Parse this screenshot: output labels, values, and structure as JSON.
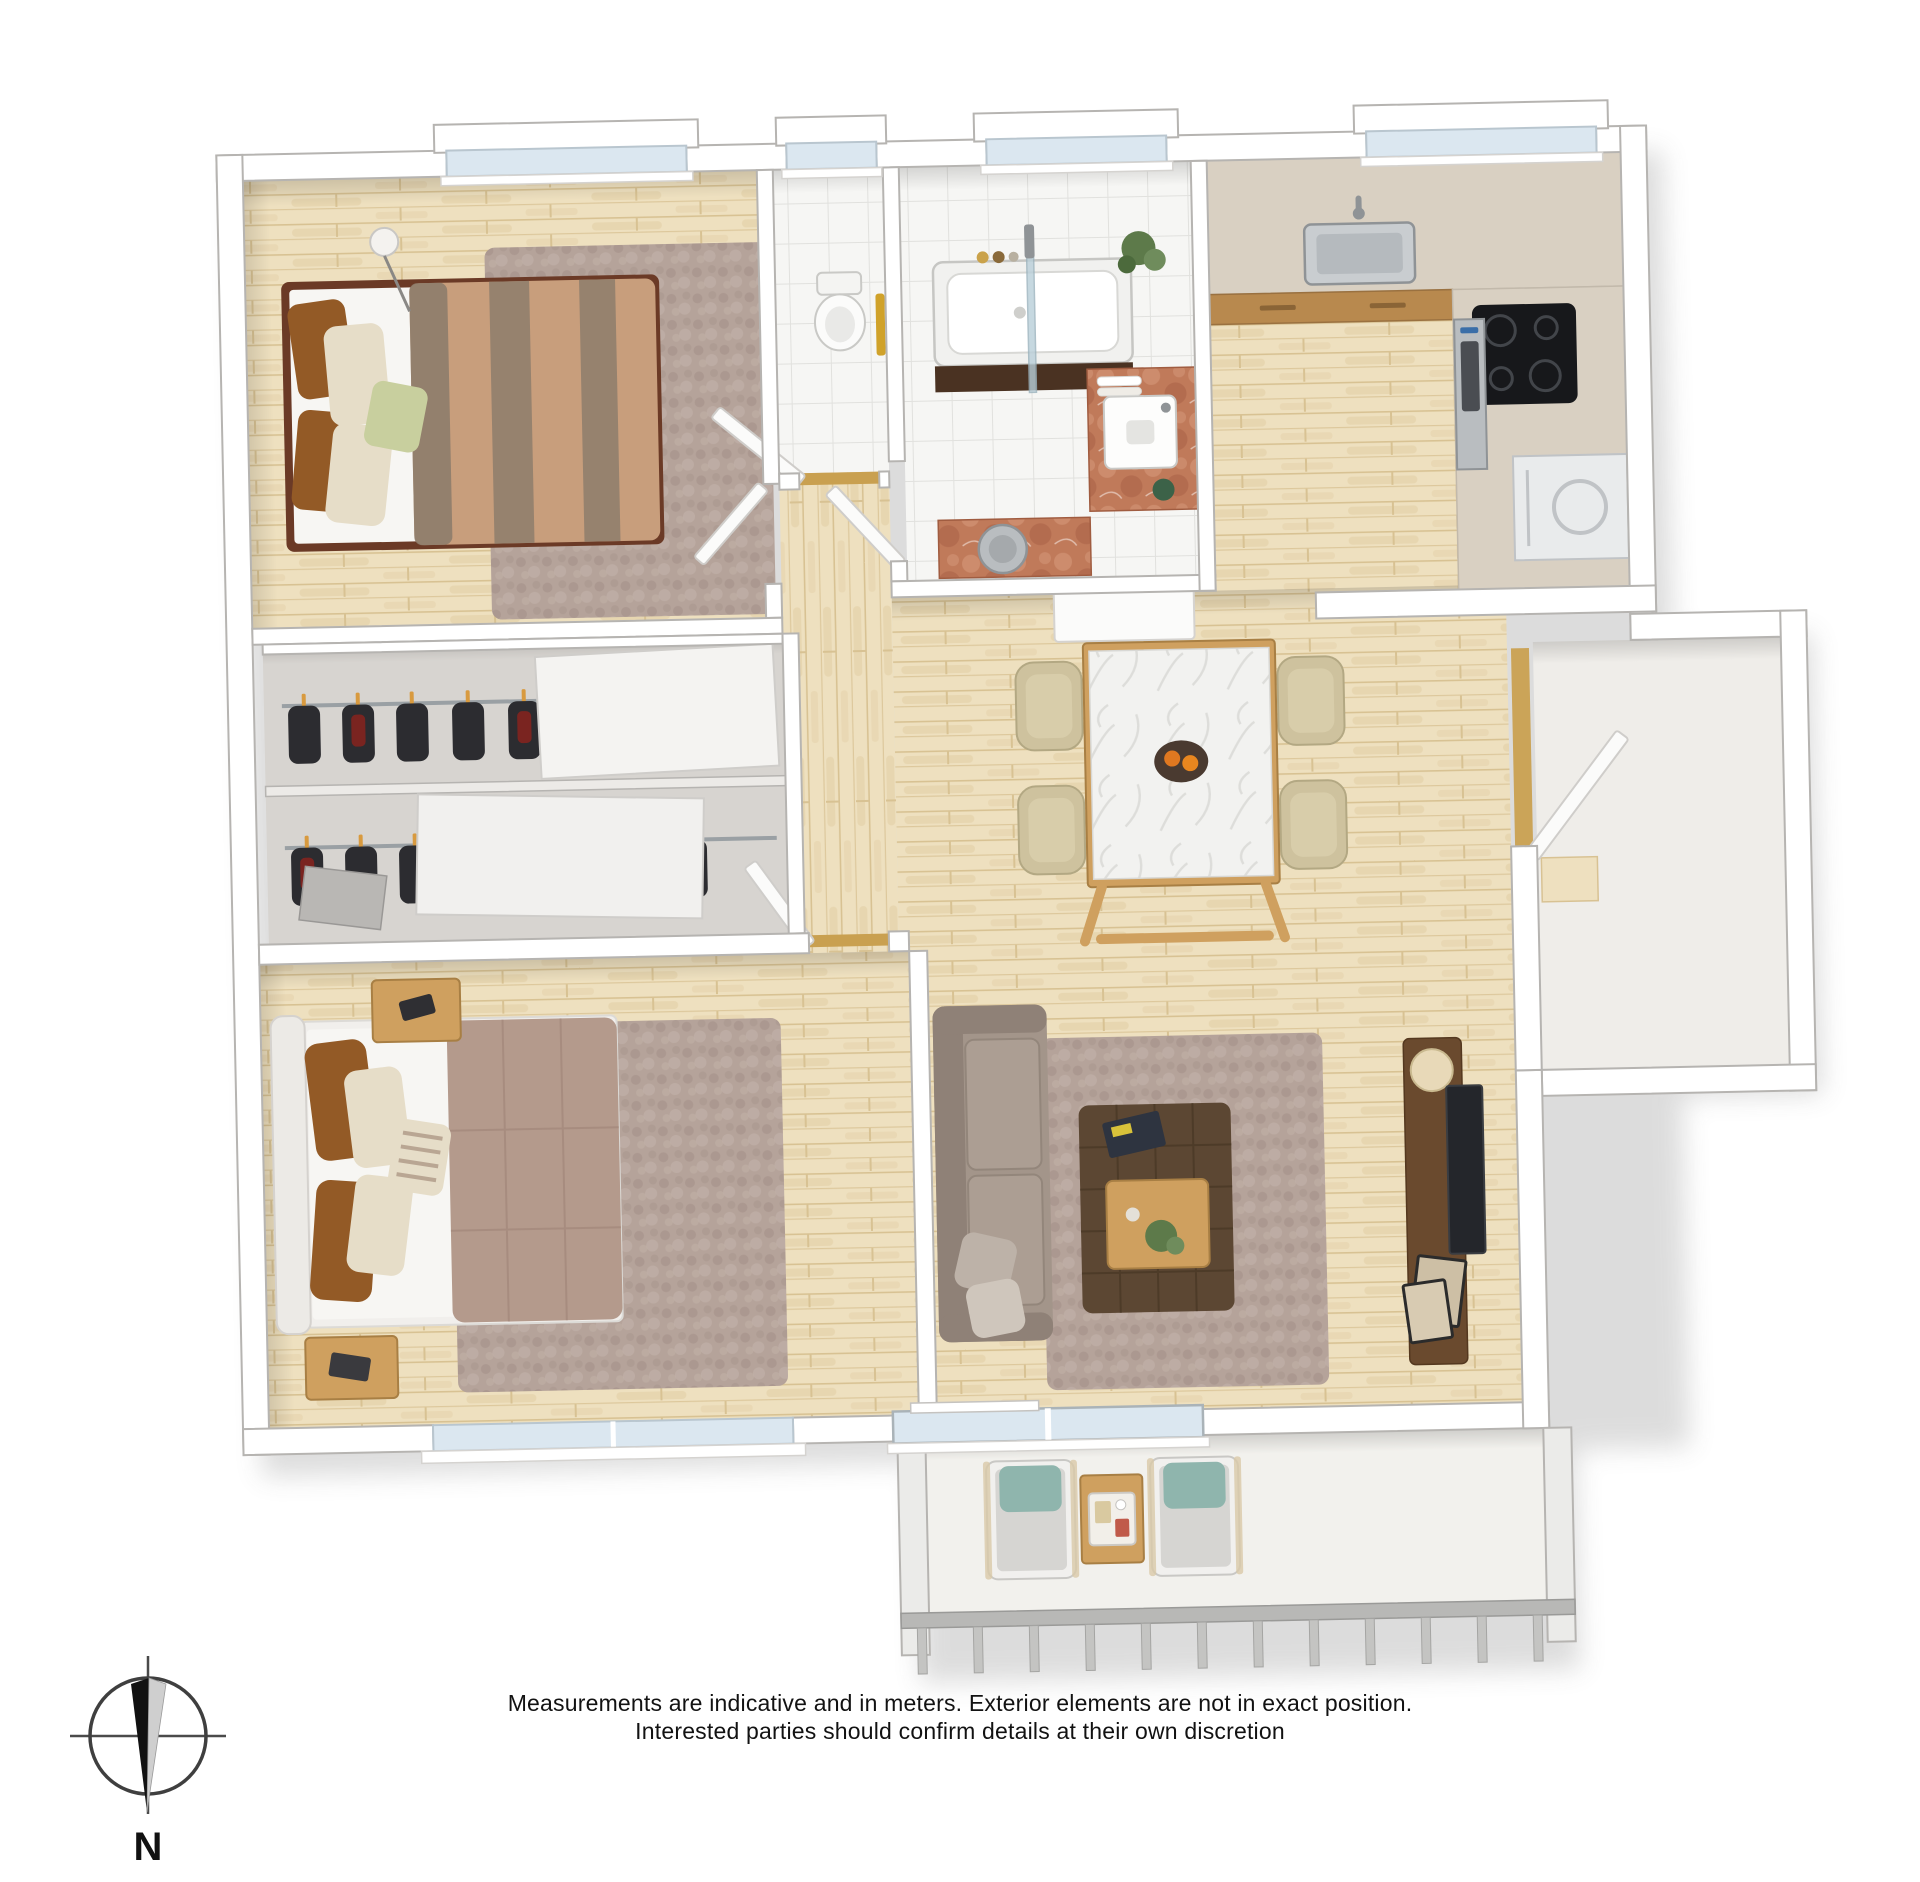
{
  "compass": {
    "label": "N",
    "needle_direction": "down",
    "ring_color": "#3f3f3f",
    "needle_dark": "#111111",
    "needle_light": "#cfcfcf"
  },
  "disclaimer": {
    "line1": "Measurements are indicative and in meters. Exterior elements are not in exact position.",
    "line2": "Interested parties should confirm details at their own discretion"
  },
  "floorplan": {
    "style": "3d-top-down-apartment-render",
    "rooms": [
      {
        "id": "bedroom-top-left",
        "type": "bedroom",
        "furniture": [
          "double-bed",
          "striped-duvet",
          "pillows",
          "area-rug",
          "floor-lamp",
          "window"
        ]
      },
      {
        "id": "wc",
        "type": "toilet-room",
        "furniture": [
          "toilet",
          "yellow-towel",
          "tiled-floor",
          "window",
          "open-door"
        ]
      },
      {
        "id": "bathroom",
        "type": "bathroom",
        "furniture": [
          "bathtub",
          "glass-shower-screen",
          "dark-tub-panel",
          "terracotta-vanity",
          "rectangular-sink",
          "round-laundry-basin",
          "towels",
          "plant",
          "window",
          "open-door"
        ]
      },
      {
        "id": "kitchen",
        "type": "kitchen",
        "furniture": [
          "stone-countertop",
          "wood-cabinets",
          "stainless-sink",
          "faucet",
          "cooktop-4-burners",
          "oven",
          "white-appliance",
          "window"
        ]
      },
      {
        "id": "wardrobe-block",
        "type": "walk-in-closet",
        "furniture": [
          "clothes-rail-upper",
          "clothes-rail-lower",
          "hanging-garments",
          "sliding-white-panels",
          "shoe-shelf"
        ]
      },
      {
        "id": "bedroom-bottom-left",
        "type": "master-bedroom",
        "furniture": [
          "double-bed",
          "white-headboard",
          "mauve-quilted-duvet",
          "pillows",
          "nightstand-top",
          "nightstand-bottom",
          "area-rug",
          "window",
          "open-door"
        ]
      },
      {
        "id": "dining-area",
        "type": "dining",
        "furniture": [
          "marble-dining-table",
          "beige-chairs-x4",
          "fruit-bowl",
          "white-sideboard"
        ]
      },
      {
        "id": "living-area",
        "type": "living",
        "furniture": [
          "corner-sofa",
          "throw-pillows",
          "area-rug",
          "tufted-ottoman-table",
          "wooden-tray",
          "magazines",
          "tv-console",
          "tv",
          "picture-frames",
          "sphere-lamp",
          "sliding-glass-door"
        ]
      },
      {
        "id": "entry-hall",
        "type": "entry",
        "furniture": [
          "open-entry-door",
          "wood-threshold"
        ]
      },
      {
        "id": "balcony",
        "type": "balcony",
        "furniture": [
          "lounge-chair-left",
          "lounge-chair-right",
          "wooden-side-table",
          "serving-tray",
          "railing-balusters"
        ]
      }
    ],
    "colors": {
      "wall_cap": "#ffffff",
      "wall_stroke": "#b6b4b1",
      "wall_face": "#d8d4cf",
      "wood": "#eee0bf",
      "wood_streak": "#e2cda3",
      "wood_line": "#d8c293",
      "tile": "#f6f6f4",
      "tile_line": "#e1e1de",
      "rug": "#b5a39a",
      "rug_dot": "#a18e85",
      "rug_light": "#c6b6ad",
      "duvet_tan": "#c89e7c",
      "duvet_stripe": "#8d7c6c",
      "duvet_mauve": "#b49a8c",
      "quilt_line": "#9c8275",
      "pillow_rust": "#935a26",
      "pillow_cream": "#e6ddc8",
      "pillow_green": "#c8cf9e",
      "headboard_white": "#eceae6",
      "sheet_white": "#f7f6f3",
      "bedframe": "#6b3a26",
      "sofa": "#a3958a",
      "sofa_dark": "#8f8177",
      "ottoman": "#5c4733",
      "tray_wood": "#cfa05f",
      "console_brown": "#6a4a2e",
      "tv_dark": "#24262b",
      "marble": "#f2f2f0",
      "marble_vein": "#dbdbd8",
      "chair_beige": "#cec29e",
      "counter_stone": "#d9d0c2",
      "cabinet_wood": "#b8894e",
      "hob": "#17181b",
      "steel": "#b9bdc0",
      "steel_dark": "#8f9396",
      "terracotta": "#c07a5a",
      "terracotta_dark": "#a45c42",
      "terracotta_light": "#d69a7c",
      "towel_yellow": "#d0a22a",
      "plant_green": "#5d7a4a",
      "teal": "#8fb5ad",
      "balcony_floor": "#f2f1ed",
      "railing": "#b8b8b6",
      "glass": "#dbe7f0",
      "garment_dark": "#2c2c30",
      "garment_red": "#7a2420",
      "hanger_orange": "#d89a3f",
      "threshold_gold": "#c9a050"
    }
  }
}
